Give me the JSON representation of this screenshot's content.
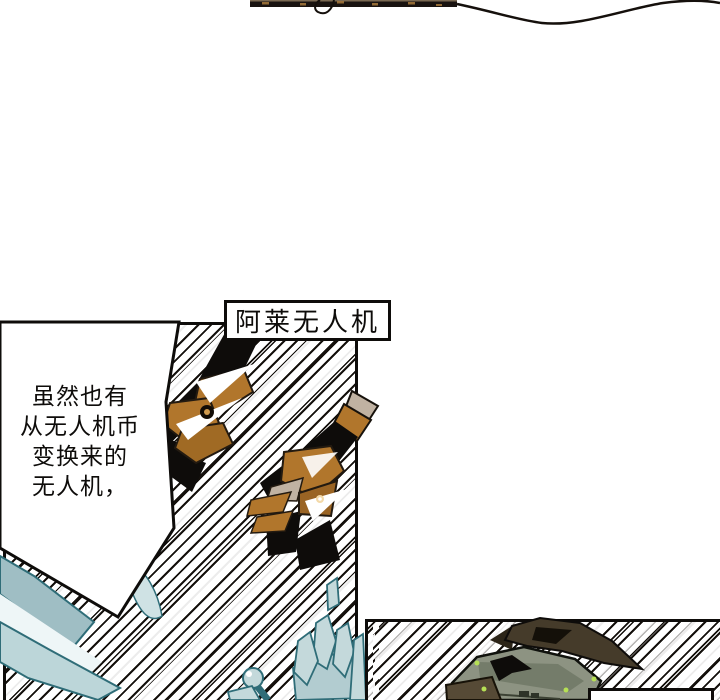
{
  "page": {
    "type": "comic-page",
    "background": "#ffffff",
    "ink_color": "#0e0c0a"
  },
  "panel_label": {
    "text": "阿莱无人机"
  },
  "bubble": {
    "lines": [
      "虽然也有",
      "从无人机币",
      "变换来的",
      "无人机，"
    ]
  },
  "bottom_label": {
    "text": ""
  },
  "colors": {
    "ink": "#0e0c0a",
    "drone_orange": "#b1762c",
    "drone_orange_dark": "#6e4a1d",
    "metal_gray": "#c0b2a2",
    "ice_cyan": "#c4d9db",
    "ice_cyan_deep": "#9fbec4",
    "ice_outline": "#2f6d78",
    "military_olive": "#8d9382",
    "military_brown": "#453b2a",
    "glow_green": "#b6e055"
  }
}
